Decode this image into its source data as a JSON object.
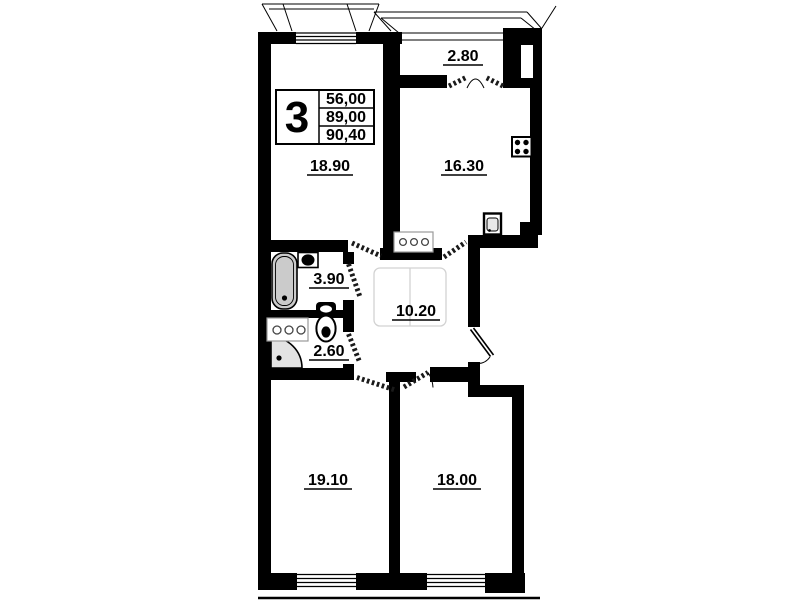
{
  "apartment_info": {
    "number": "3",
    "rows": [
      "56,00",
      "89,00",
      "90,40"
    ]
  },
  "rooms": {
    "living": "18.90",
    "kitchen": "16.30",
    "balcony": "2.80",
    "bathroom": "3.90",
    "wc": "2.60",
    "hallway": "10.20",
    "bedroom_left": "19.10",
    "bedroom_right": "18.00"
  },
  "icons": [
    "bathtub-icon",
    "washbasin-icon",
    "toilet-icon",
    "shower-tray-icon",
    "stove-icon",
    "kitchen-sink-icon",
    "kitchen-counter-icon",
    "wc-counter-icon",
    "wardrobe-outline-icon"
  ],
  "colors": {
    "wall": "#000000",
    "fixture_fill": "#cbcbcb",
    "faint_outline": "#d2d2d2",
    "background": "#ffffff",
    "text": "#000000"
  }
}
